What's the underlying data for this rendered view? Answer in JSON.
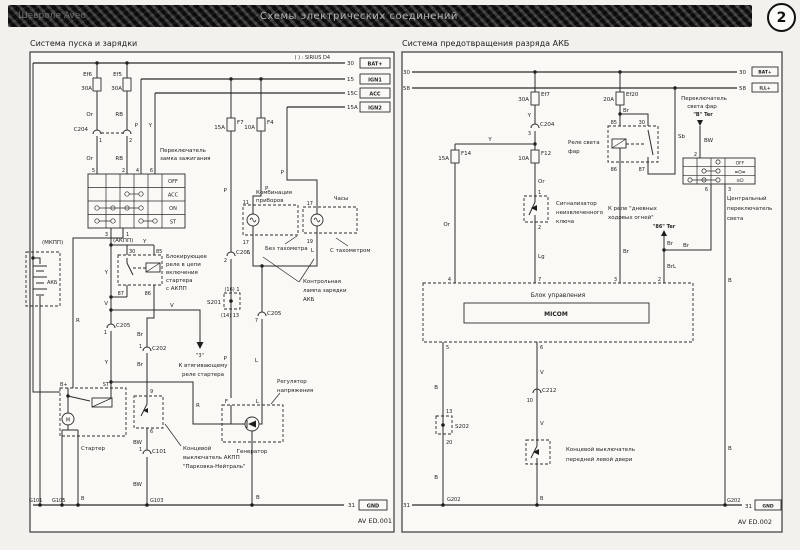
{
  "header": {
    "left_title": "Шевроле Aveo",
    "center_title": "Схемы электрических соединений",
    "page_badge": "2"
  },
  "wires": {
    "or": "Or",
    "rb": "RB",
    "p": "P",
    "y": "Y",
    "v": "V",
    "br": "Br",
    "bw": "BW",
    "b": "B",
    "l": "L",
    "r": "R",
    "lg": "Lg",
    "sb": "Sb",
    "brl": "BrL"
  },
  "pins": {
    "1": "1",
    "2": "2",
    "3": "3",
    "4": "4",
    "5": "5",
    "6": "6",
    "7": "7",
    "9": "9",
    "10": "10",
    "11": "11",
    "13": "13",
    "17": "17",
    "19": "19",
    "30": "30",
    "85": "85",
    "86": "86",
    "87": "87"
  },
  "left": {
    "title": "Система пуска и зарядки",
    "note": "( ) : SIRIUS D4",
    "bus": {
      "b30": "30",
      "bat": "BAT+",
      "b15": "15",
      "ign1": "IGN1",
      "b15c": "15C",
      "acc": "ACC",
      "b15a": "15A",
      "ign2": "IGN2",
      "b31": "31",
      "gnd": "GND"
    },
    "fuses": {
      "ef6": "Ef6",
      "ef5": "Ef5",
      "f7": "F7",
      "f4": "F4",
      "a30": "30A",
      "a15": "15A",
      "a10": "10A"
    },
    "conn": {
      "c204": "C204",
      "c205": "C205",
      "c202": "C202",
      "c101": "C101",
      "s201": "S201",
      "s201_top": "(16) 1",
      "s201_bot": "(14) 13"
    },
    "ign": {
      "l1": "Переключатель",
      "l2": "замка зажигания",
      "rows": [
        "OFF",
        "ACC",
        "ON",
        "ST"
      ]
    },
    "texts": {
      "mkpp": "(МКПП)",
      "akpp": "(АКПП)",
      "akb": "АКБ",
      "relay1": "Блокирующее",
      "relay2": "реле в цепи",
      "relay3": "включения",
      "relay4": "стартера",
      "relay5": "с АКПП",
      "cluster1": "Комбинация",
      "cluster2": "приборов",
      "clock": "Часы",
      "no_tach": "Без тахометра",
      "with_tach": "С тахометром",
      "charge1": "Контрольная",
      "charge2": "лампа зарядки",
      "charge3": "АКБ",
      "reg1": "Регулятор",
      "reg2": "напряжения",
      "gen": "Генератор",
      "starter": "Стартер",
      "bplus": "B+",
      "st": "ST",
      "m": "M",
      "sol_ref": "\"3\"",
      "sol1": "К втягивающему",
      "sol2": "реле стартера",
      "at1": "Концевой",
      "at2": "выключатель АКПП",
      "at3": "\"Парковка-Нейтраль\"",
      "g101": "G101",
      "g105": "G105",
      "g103": "G103"
    },
    "footer": "AV ED.001"
  },
  "right": {
    "title": "Система предотвращения разряда АКБ",
    "bus": {
      "b30": "30",
      "bat": "BAT+",
      "b58": "58",
      "ill": "ILL+",
      "b31": "31",
      "gnd": "GND"
    },
    "fuses": {
      "ef7": "Ef7",
      "ef20": "Ef20",
      "f14": "F14",
      "f12": "F12",
      "a30": "30A",
      "a20": "20A",
      "a15": "15A",
      "a10": "10A"
    },
    "conn": {
      "c204": "C204",
      "c212": "C212",
      "s202": "S202",
      "s202_top": "13",
      "s202_bot": "20",
      "g202": "G202"
    },
    "sw": {
      "off": "OFF",
      "park": "≡O≡",
      "head": "≡D"
    },
    "texts": {
      "relay1": "Реле света",
      "relay2": "фар",
      "key1": "Сигнализатор",
      "key2": "неизвлеченного",
      "key3": "ключа",
      "hs1": "Переключатель",
      "hs2": "света фар",
      "hs3": "\"B\" Ter",
      "drl1": "К реле \"дневных",
      "drl2": "ходовых огней\"",
      "drl3": "\"86\" Ter",
      "central1": "Центральный",
      "central2": "переключатель",
      "central3": "света",
      "micom_box": "Блок управления",
      "micom": "MICOM",
      "door1": "Концевой выключатель",
      "door2": "передней левой двери"
    },
    "footer": "AV ED.002"
  }
}
